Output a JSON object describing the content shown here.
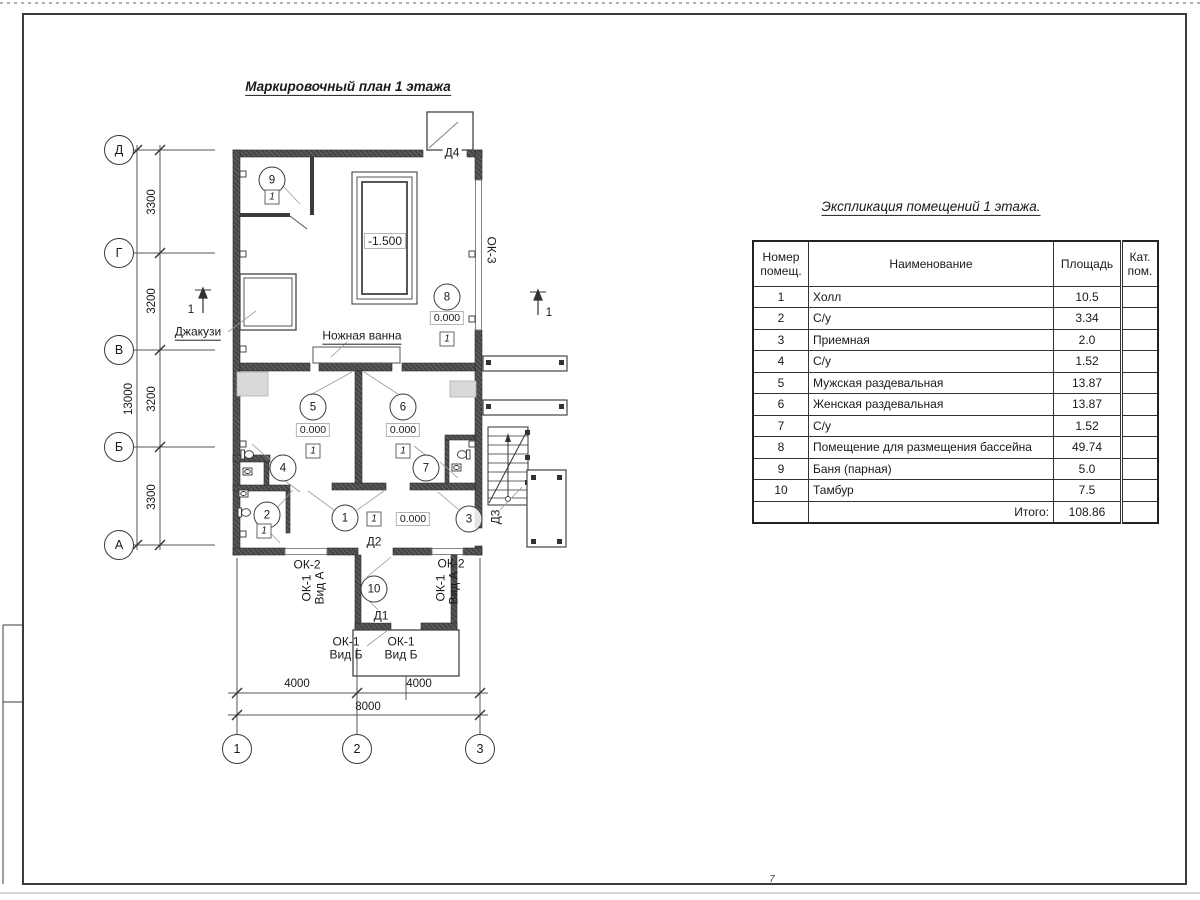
{
  "sheet": {
    "plan_title": "Маркировочный план 1 этажа",
    "corner_mark": "7"
  },
  "axes": {
    "rows": [
      "Д",
      "Г",
      "В",
      "Б",
      "А"
    ],
    "row_dims": [
      "3300",
      "3200",
      "3200",
      "3300"
    ],
    "row_total": "13000",
    "cols": [
      "1",
      "2",
      "3"
    ],
    "col_dims": [
      "4000",
      "4000"
    ],
    "col_total": "8000",
    "section_mark": "1"
  },
  "plan": {
    "room_numbers": {
      "n1": "1",
      "n2": "2",
      "n3": "3",
      "n4": "4",
      "n5": "5",
      "n6": "6",
      "n7": "7",
      "n8": "8",
      "n9": "9",
      "n10": "10"
    },
    "levels": {
      "zero": "0.000",
      "pool": "-1.500"
    },
    "floor_type_mark": "1",
    "labels": {
      "jacuzzi": "Джакузи",
      "foot_bath": "Ножная ванна"
    },
    "doors": {
      "d1": "Д1",
      "d2": "Д2",
      "d3": "Д3",
      "d4": "Д4"
    },
    "windows": {
      "ok2": "ОК-2",
      "ok3": "ОК-3",
      "ok1": "ОК-1",
      "vid_a": "Вид А",
      "vid_b": "Вид Б"
    }
  },
  "table": {
    "title": "Экспликация помещений 1 этажа.",
    "headers": {
      "num": "Номер помещ.",
      "name": "Наименование",
      "area": "Площадь",
      "cat": "Кат. пом."
    },
    "rows": [
      {
        "num": "1",
        "name": "Холл",
        "area": "10.5",
        "cat": ""
      },
      {
        "num": "2",
        "name": "С/у",
        "area": "3.34",
        "cat": ""
      },
      {
        "num": "3",
        "name": "Приемная",
        "area": "2.0",
        "cat": ""
      },
      {
        "num": "4",
        "name": "С/у",
        "area": "1.52",
        "cat": ""
      },
      {
        "num": "5",
        "name": "Мужская раздевальная",
        "area": "13.87",
        "cat": ""
      },
      {
        "num": "6",
        "name": "Женская раздевальная",
        "area": "13.87",
        "cat": ""
      },
      {
        "num": "7",
        "name": "С/у",
        "area": "1.52",
        "cat": ""
      },
      {
        "num": "8",
        "name": "Помещение для размещения бассейна",
        "area": "49.74",
        "cat": ""
      },
      {
        "num": "9",
        "name": "Баня (парная)",
        "area": "5.0",
        "cat": ""
      },
      {
        "num": "10",
        "name": "Тамбур",
        "area": "7.5",
        "cat": ""
      }
    ],
    "total_label": "Итого:",
    "total_value": "108.86"
  }
}
